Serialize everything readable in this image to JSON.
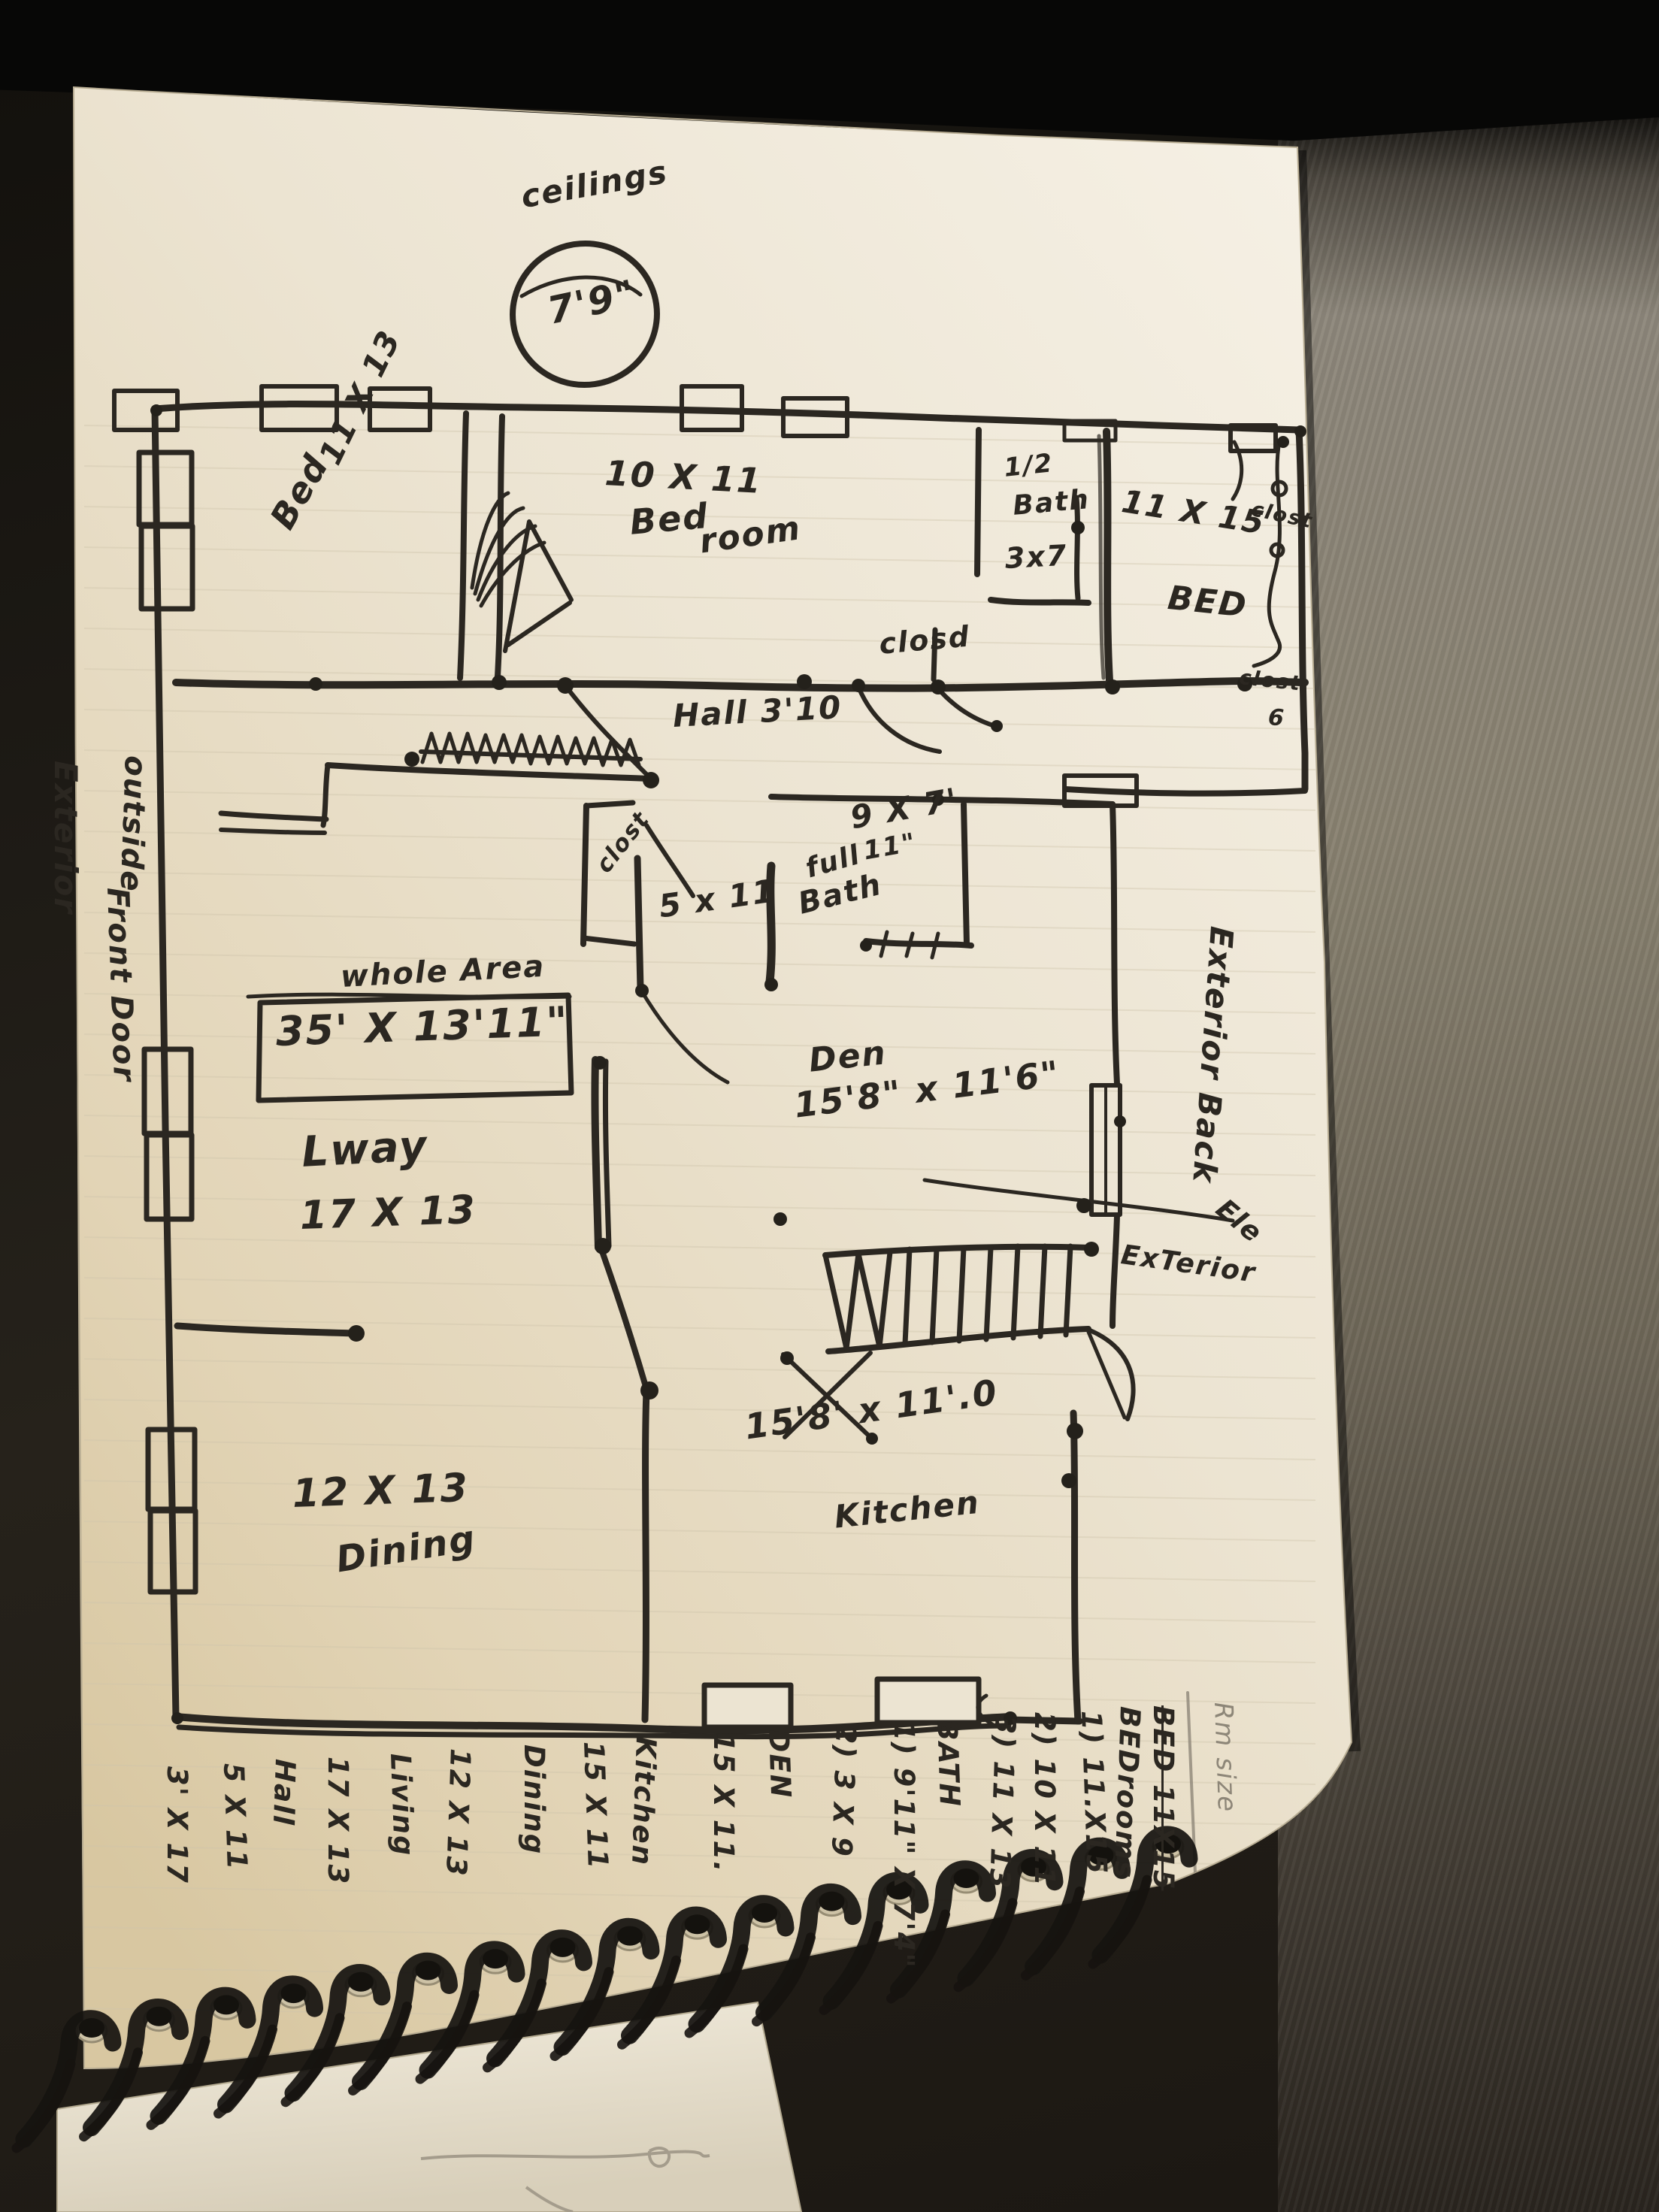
{
  "annotations": {
    "ceiling": {
      "word": "ceilings",
      "height": "7'9\""
    },
    "hall": "Hall 3'10",
    "whole_area_label": "whole Area",
    "whole_area_dims": "35' X 13'11\"",
    "ele": "Ele",
    "exterior_stairs": "ExTerior",
    "exterior_back": "Exterior Back",
    "exterior_left": "Exterior",
    "front_door_word": "outside",
    "front_door": "Front Door"
  },
  "rooms": {
    "bedroom_topleft": {
      "name": "Bed",
      "dims": "11 X 13"
    },
    "bedroom_topmid": {
      "dims": "10 X 11",
      "name_l1": "Bed",
      "name_l2": "room"
    },
    "half_bath": {
      "l1": "1/2",
      "l2": "Bath",
      "l3": "3x7"
    },
    "closet_hall": "closd",
    "bedroom_right": {
      "dims": "11 X 15",
      "name": "BED"
    },
    "closet_right_top": "clost",
    "closet_right_bottom": "clost",
    "closet_right_num": "6",
    "closet_mid": "clost",
    "closet_mid_dims": "5 x 11",
    "full_bath": {
      "l1": "full",
      "l2": "Bath",
      "dims_l1": "9 X 7'",
      "dims_l2": "11\""
    },
    "living": {
      "name": "Lway",
      "dims": "17 X 13"
    },
    "den": {
      "name": "Den",
      "dims": "15'8\" x 11'6\""
    },
    "dining": {
      "dims": "12 X 13",
      "name": "Dining"
    },
    "kitchen": {
      "dims": "15'8' x 11'.0",
      "name": "Kitchen"
    }
  },
  "summary_list": [
    "Rm size",
    "BED 11X15",
    "BEDrooms",
    "1) 11.X15",
    "2) 10 X 11",
    "3) 11 X 13",
    "BATH",
    "1) 9'11\" X 7'4\"",
    "2) 3 X 9",
    "DEN",
    "15 X 11.",
    "Kitchen",
    "15 X 11",
    "Dining",
    "12 X 13",
    "Living",
    "17 X 13",
    "Hall",
    "5 X 11",
    "3' X 17"
  ],
  "colors": {
    "ink": "#2b2721",
    "paper": "#ece4d2",
    "pencil": "#8d8678",
    "desk": "#7d766a",
    "background": "#0a0908"
  }
}
